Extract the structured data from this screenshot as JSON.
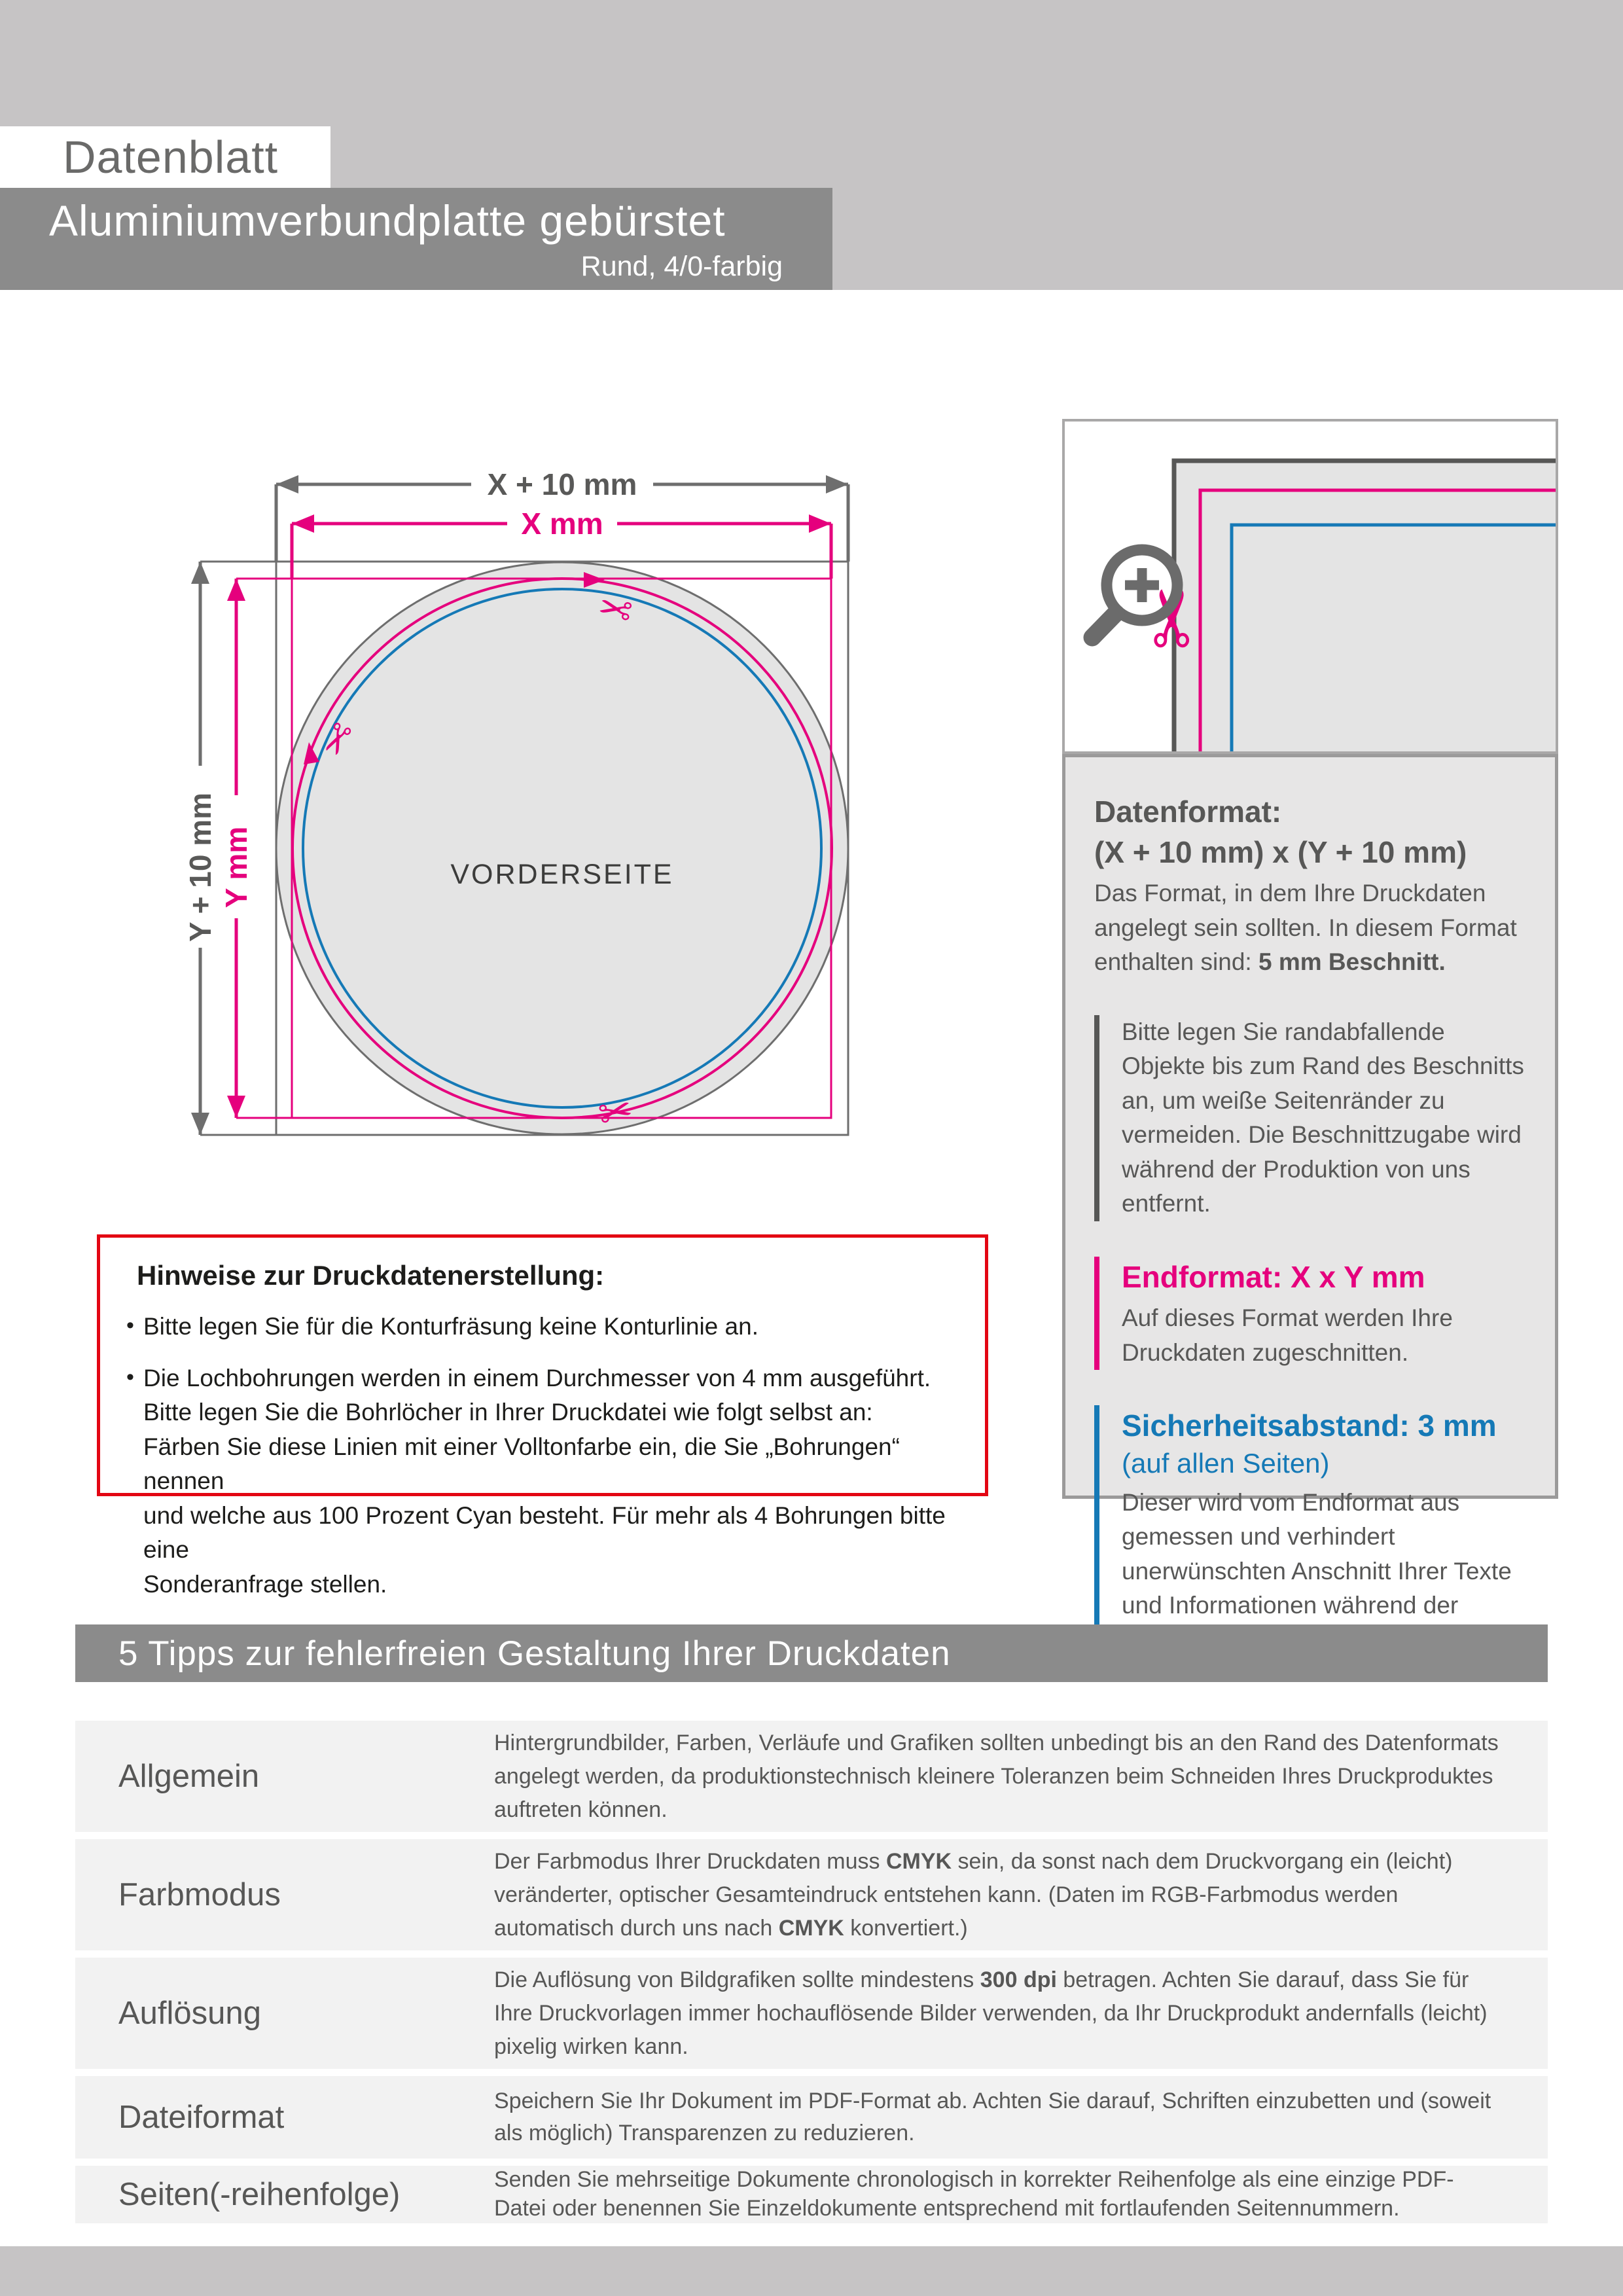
{
  "header": {
    "tag": "Datenblatt",
    "product_title": "Aluminiumverbundplatte gebürstet",
    "product_subtitle": "Rund, 4/0-farbig"
  },
  "diagram": {
    "dim_x_outer": "X + 10 mm",
    "dim_x_inner": "X mm",
    "dim_y_outer": "Y + 10 mm",
    "dim_y_inner": "Y mm",
    "front_label": "VORDERSEITE"
  },
  "icons": {
    "scissors": "✂",
    "magnifier": "zoom-plus-magnifier"
  },
  "notes": {
    "title": "Hinweise zur Druckdatenerstellung:",
    "bullets": [
      "Bitte legen Sie für die Konturfräsung keine Konturlinie an.",
      "Die Lochbohrungen werden in einem Durchmesser von 4 mm ausgeführt.\nBitte legen Sie die Bohrlöcher in Ihrer Druckdatei wie folgt selbst an:\nFärben Sie diese Linien mit einer Volltonfarbe ein, die Sie „Bohrungen“ nennen\nund welche aus 100 Prozent Cyan besteht. Für mehr als 4 Bohrungen bitte eine\nSonderanfrage stellen."
    ]
  },
  "info_panel": {
    "datenformat_title": "Datenformat:",
    "datenformat_value": "(X + 10 mm) x (Y + 10 mm)",
    "datenformat_body": "Das Format, in dem Ihre Druckdaten angelegt sein sollten. In diesem Format enthalten sind: ",
    "datenformat_body_bold": "5 mm Beschnitt.",
    "bleed_note": "Bitte legen Sie randabfallende Objekte bis zum Rand des Beschnitts an, um weiße Seitenränder zu vermeiden. Die Beschnittzugabe wird während der Produktion von uns entfernt.",
    "endformat_title": "Endformat: X x Y mm",
    "endformat_body": "Auf dieses Format werden Ihre Druckdaten zugeschnitten.",
    "safety_title": "Sicherheitsabstand: 3 mm",
    "safety_subtitle": "(auf allen Seiten)",
    "safety_body": "Dieser wird vom Endformat aus gemessen und verhindert unerwünschten Anschnitt Ihrer Texte und Informationen während der Produktion."
  },
  "tips": {
    "banner": "5 Tipps zur fehlerfreien Gestaltung Ihrer Druckdaten",
    "rows": [
      {
        "label": "Allgemein",
        "t1": "Hintergrundbilder, Farben, Verläufe und Grafiken sollten unbedingt bis an den Rand des Datenformats angelegt werden, da produktionstechnisch kleinere Toleranzen beim Schneiden Ihres Druckproduktes auftreten können."
      },
      {
        "label": "Farbmodus",
        "t1": "Der Farbmodus Ihrer Druckdaten muss ",
        "b1": "CMYK",
        "t2": " sein, da sonst nach dem Druckvorgang ein (leicht) veränderter, optischer Gesamteindruck entstehen kann. (Daten im RGB-Farbmodus werden automatisch durch uns nach ",
        "b2": "CMYK",
        "t3": " konvertiert.)"
      },
      {
        "label": "Auflösung",
        "t1": "Die Auflösung von Bildgrafiken sollte mindestens ",
        "b1": "300 dpi",
        "t2": " betragen. Achten Sie darauf, dass Sie für Ihre Druckvorlagen immer hochauflösende Bilder verwenden, da Ihr Druckprodukt andernfalls (leicht) pixelig wirken kann."
      },
      {
        "label": "Dateiformat",
        "t1": "Speichern Sie Ihr Dokument im PDF-Format ab. Achten Sie darauf, Schriften einzubetten und (soweit als möglich) Transparenzen zu reduzieren."
      },
      {
        "label": "Seiten(-reihenfolge)",
        "t1": "Senden Sie mehrseitige Dokumente chronologisch in korrekter Reihenfolge als eine einzige PDF-Datei oder benennen Sie Einzeldokumente entsprechend mit fortlaufenden Seitennummern."
      }
    ]
  },
  "colors": {
    "magenta_endformat": "#e5007d",
    "blue_safety": "#1579b6",
    "red_notes_border": "#e30613",
    "banner_gray": "#8b8b8b",
    "band_gray": "#c6c4c5",
    "text_gray": "#575756"
  }
}
